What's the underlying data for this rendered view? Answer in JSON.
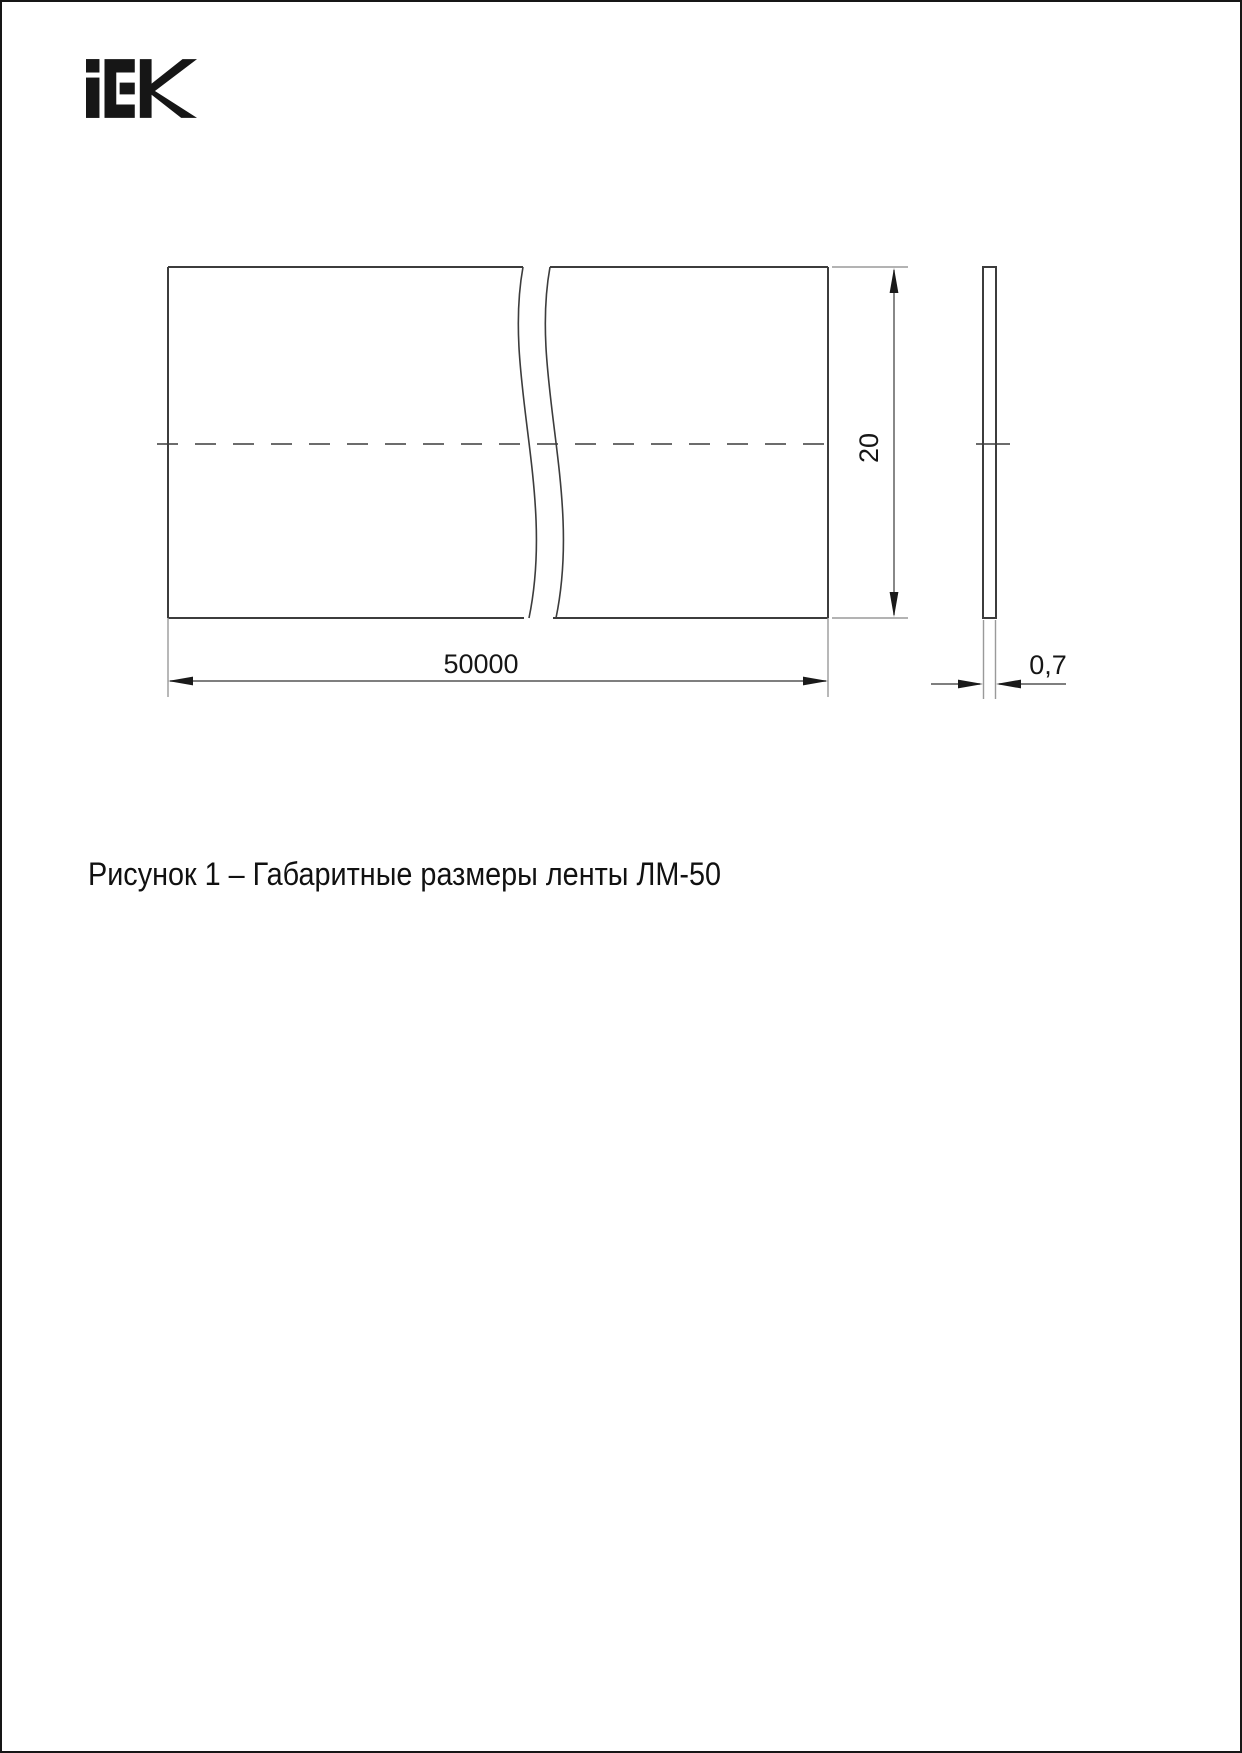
{
  "page": {
    "background": "#ffffff",
    "border_color": "#161616"
  },
  "logo": {
    "name": "iek-logo",
    "alt": "IEK"
  },
  "figure": {
    "caption": "Рисунок 1 – Габаритные размеры ленты ЛМ-50",
    "dimensions": {
      "length": "50000",
      "width": "20",
      "thickness": "0,7"
    }
  },
  "colors": {
    "outline": "#3c3c3c",
    "thin_line": "#9a9a9a",
    "dim_line": "#555555",
    "arrow": "#1a1a1a",
    "text": "#161616"
  }
}
